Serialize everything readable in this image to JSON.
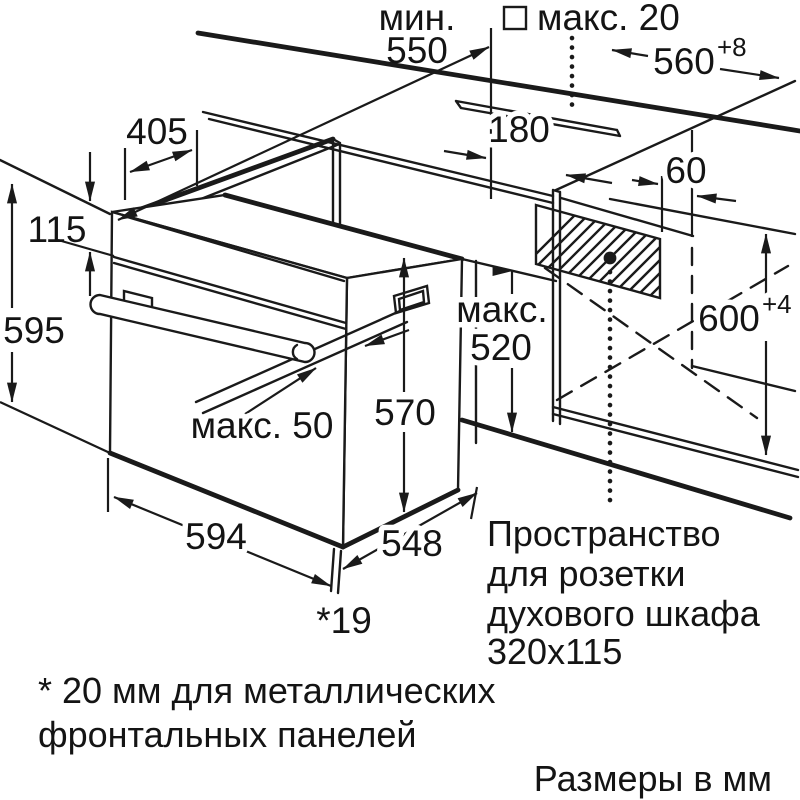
{
  "diagram": {
    "kind": "oven installation dimension drawing",
    "units_note": "Размеры в мм",
    "colors": {
      "line": "#1a1a1a",
      "background": "#ffffff"
    }
  },
  "labels": {
    "min_word": "мин.",
    "min_value": "550",
    "hob_max": "макс. 20",
    "niche_width": "560",
    "niche_width_tol": "+8",
    "top_depth": "405",
    "panel_height": "115",
    "front_height": "595",
    "socket_offset": "180",
    "side_offset": "60",
    "niche_height": "600",
    "niche_height_tol": "+4",
    "inner_max_word": "макс.",
    "inner_max_value": "520",
    "body_height": "570",
    "handle_max": "макс. 50",
    "oven_width": "594",
    "body_depth": "548",
    "door_proud": "*19",
    "socket_note_1": "Пространство",
    "socket_note_2": "для розетки",
    "socket_note_3": "духового шкафа",
    "socket_note_4": "320x115",
    "footnote_1": "* 20 мм для металлических",
    "footnote_2": "фронтальных панелей",
    "units": "Размеры в мм"
  }
}
